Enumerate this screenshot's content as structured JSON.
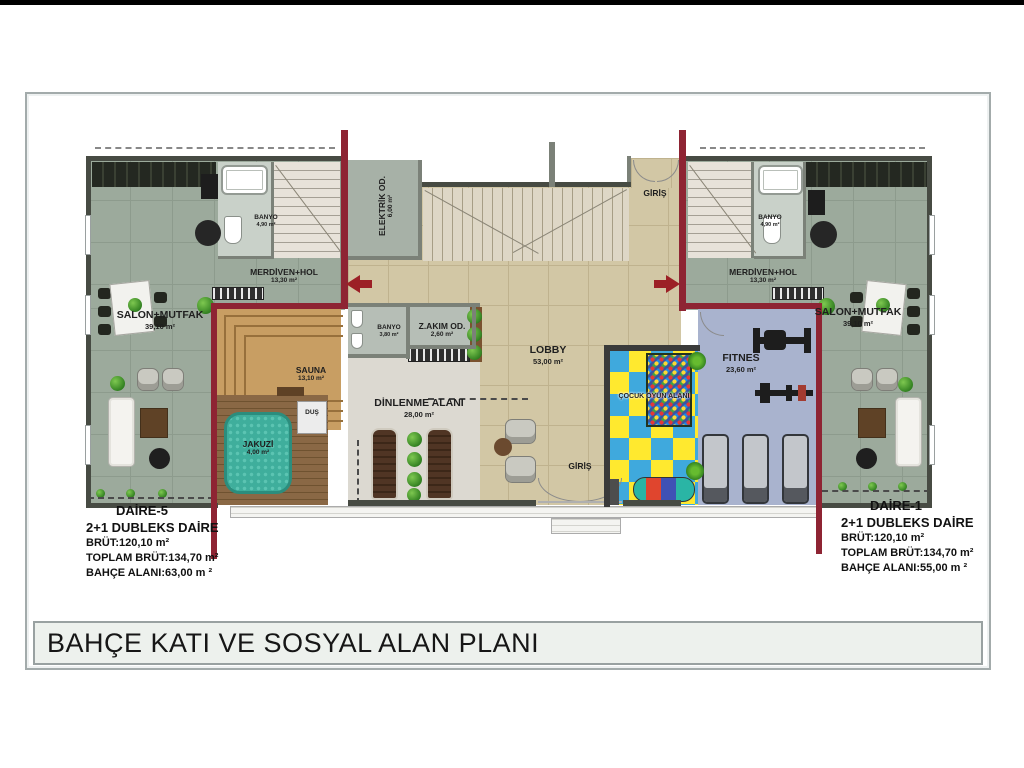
{
  "title_bar": {
    "title": "BAHÇE KATI VE SOSYAL ALAN PLANI"
  },
  "info_left": {
    "name": "DAİRE-5",
    "type": "2+1 DUBLEKS DAİRE",
    "brut": "BRÜT:120,10 m²",
    "toplam": "TOPLAM BRÜT:134,70 m²",
    "bahce": "BAHÇE ALANI:63,00 m ²"
  },
  "info_right": {
    "name": "DAİRE-1",
    "type": "2+1 DUBLEKS DAİRE",
    "brut": "BRÜT:120,10 m²",
    "toplam": "TOPLAM BRÜT:134,70 m²",
    "bahce": "BAHÇE ALANI:55,00 m ²"
  },
  "rooms": {
    "salon_left": {
      "label": "SALON+MUTFAK",
      "area": "39,10 m²"
    },
    "banyo_left": {
      "label": "BANYO",
      "area": "4,90 m²"
    },
    "merdiven_left": {
      "label": "MERDİVEN+HOL",
      "area": "13,30 m²"
    },
    "elektrik": {
      "label": "ELEKTRİK OD.",
      "area": "6,00 m²"
    },
    "giris_top": {
      "label": "GİRİŞ"
    },
    "lobby": {
      "label": "LOBBY",
      "area": "53,00 m²"
    },
    "banyo_center": {
      "label": "BANYO",
      "area": "3,80 m²"
    },
    "zakim": {
      "label": "Z.AKIM OD.",
      "area": "2,60 m²"
    },
    "sauna": {
      "label": "SAUNA",
      "area": "13,10 m²"
    },
    "dus": {
      "label": "DUŞ"
    },
    "jakuzi": {
      "label": "JAKUZİ",
      "area": "4,00 m²"
    },
    "dinlenme": {
      "label": "DİNLENME ALANI",
      "area": "28,00 m²"
    },
    "giris_bottom": {
      "label": "GİRİŞ"
    },
    "cocuk": {
      "label": "ÇOCUK OYUN ALANI"
    },
    "fitnes": {
      "label": "FITNES",
      "area": "23,60 m²"
    },
    "banyo_right": {
      "label": "BANYO",
      "area": "4,90 m²"
    },
    "merdiven_right": {
      "label": "MERDİVEN+HOL",
      "area": "13,30 m²"
    },
    "salon_right": {
      "label": "SALON+MUTFAK",
      "area": "39,10 m²"
    }
  },
  "colors": {
    "wall_maroon": "#8e2433",
    "wall_dark": "#474b43",
    "floor_apartment": "#9caa9c",
    "floor_lobby": "#d2c7a5",
    "floor_fitness": "#a9b3ce",
    "sauna_wood": "#c89e63",
    "jakuzi_water": "#3fae9c",
    "play_yellow": "#ffe92f",
    "play_blue": "#3fa9dd"
  }
}
